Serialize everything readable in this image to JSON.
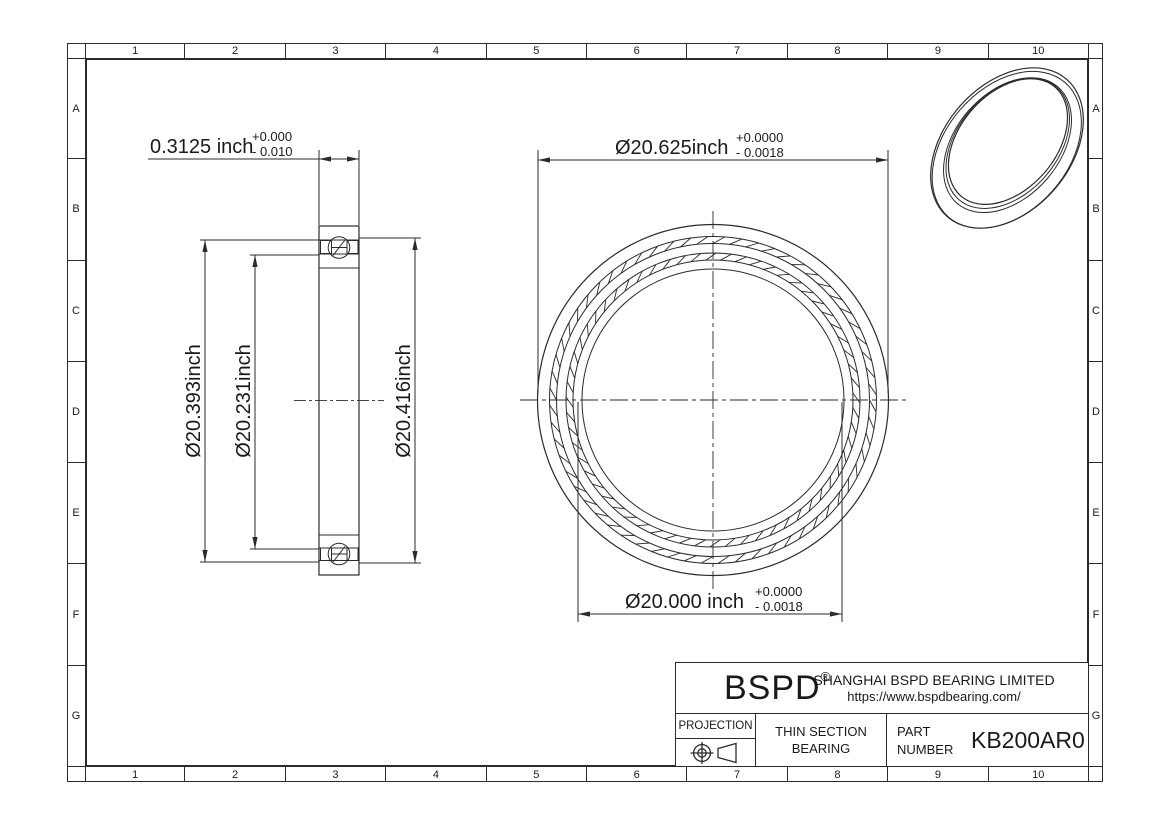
{
  "sheet": {
    "grid_columns": [
      "1",
      "2",
      "3",
      "4",
      "5",
      "6",
      "7",
      "8",
      "9",
      "10"
    ],
    "grid_rows": [
      "A",
      "B",
      "C",
      "D",
      "E",
      "F",
      "G"
    ]
  },
  "dimensions": {
    "section_width": {
      "value": "0.3125 inch",
      "tol_upper": "+0.000",
      "tol_lower": "- 0.010"
    },
    "outer_diameter": {
      "value": "Ø20.625inch",
      "tol_upper": "+0.0000",
      "tol_lower": "- 0.0018"
    },
    "bore_diameter": {
      "value": "Ø20.000 inch",
      "tol_upper": "+0.0000",
      "tol_lower": "- 0.0018"
    },
    "outer_race_diameter": "Ø20.393inch",
    "inner_race_diameter": "Ø20.231inch",
    "outer_land_diameter": "Ø20.416inch"
  },
  "title_block": {
    "logo": "BSPD",
    "registered_mark": "®",
    "company_name": "SHANGHAI BSPD BEARING LIMITED",
    "website": "https://www.bspdbearing.com/",
    "projection_label": "PROJECTION",
    "product_type_line1": "THIN SECTION",
    "product_type_line2": "BEARING",
    "part_label_line1": "PART",
    "part_label_line2": "NUMBER",
    "part_number": "KB200AR0"
  },
  "colors": {
    "line": "#2b2b2b",
    "background": "#ffffff"
  }
}
